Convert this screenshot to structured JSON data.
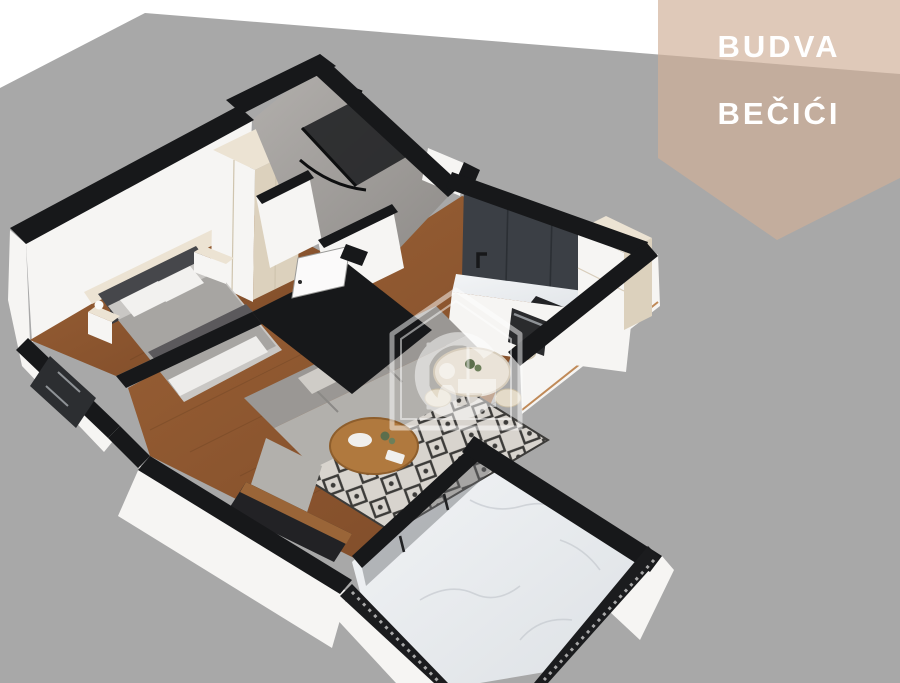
{
  "banner": {
    "location_line1": "BUDVA",
    "location_line2": "BEČIĆI"
  },
  "watermark": {
    "icon": "g-home-keyhole-logo"
  },
  "colors": {
    "bg": "#ffffff",
    "ground": "#a8a8a8",
    "banner": "rgba(208,176,152,0.68)",
    "banner-text": "#ffffff",
    "wall-top": "#17181a",
    "wall-white": "#f6f5f3",
    "wall-shadow": "#e9e7e4",
    "cream": "#ece3d3",
    "cream-dark": "#dcd1bd",
    "wood": "#8a5430",
    "wood-dark": "#6f4023",
    "dark-cabinet": "#3b3f45",
    "marble": "#eceef0",
    "marble-vein": "#c5c9ce",
    "sofa": "#9a9794",
    "sofa-light": "#b2b0ac",
    "rug-base": "#d8d4ce",
    "rug-dark": "#3c3b39",
    "stone": "#a39f9b",
    "glass": "#6a6d70",
    "watermark": "#ffffff"
  }
}
